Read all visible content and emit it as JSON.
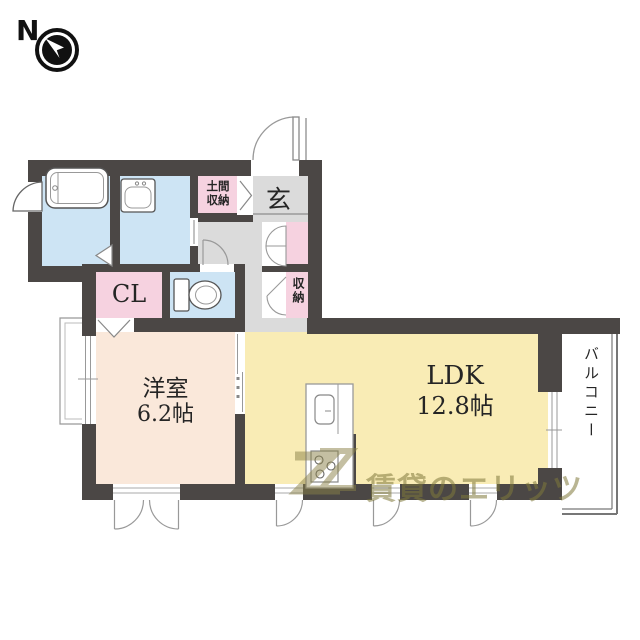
{
  "compass": {
    "label": "N"
  },
  "plan": {
    "rooms": {
      "entrance": {
        "label": "玄"
      },
      "doma_storage": {
        "label": "土間収納"
      },
      "hall_storage": {
        "label": "収納"
      },
      "closet": {
        "label": "CL"
      },
      "western_room": {
        "name": "洋室",
        "size": "6.2帖"
      },
      "ldk": {
        "name": "LDK",
        "size": "12.8帖"
      },
      "balcony": {
        "label": "バルコニー"
      }
    },
    "colors": {
      "wall": "#4b4745",
      "water_rooms": "#cde4f4",
      "storage_pink": "#f6d2e0",
      "hallway": "#dbdbdb",
      "western_room": "#fae8da",
      "ldk": "#f9ecb5",
      "balcony": "#ffffff"
    }
  },
  "watermark": {
    "text": "賃貸のエリッツ"
  }
}
